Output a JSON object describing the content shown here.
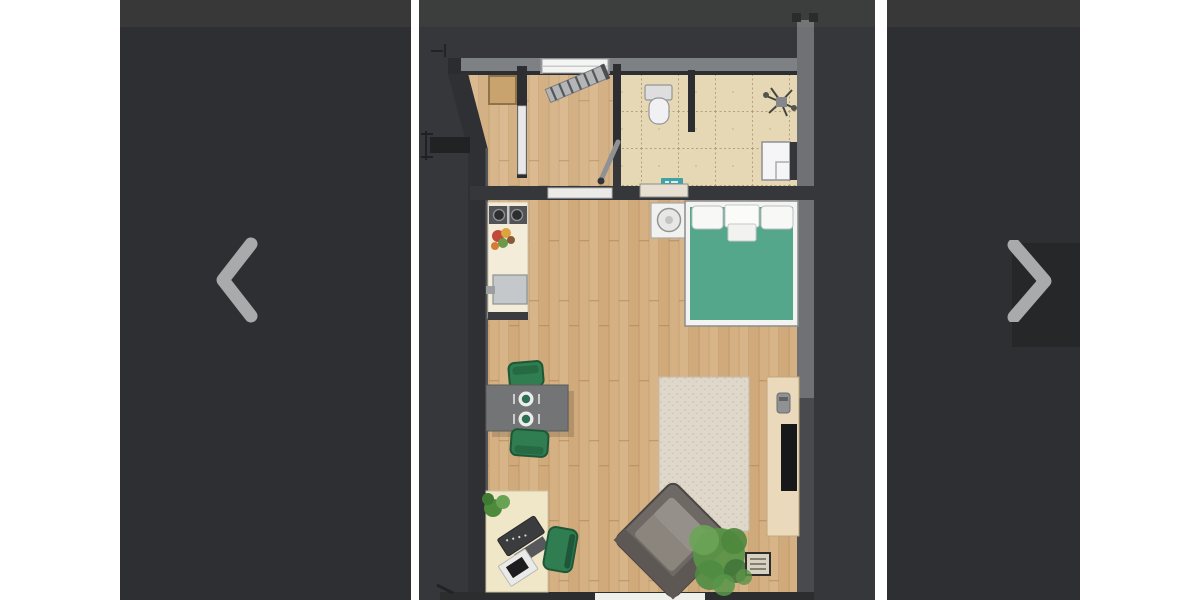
{
  "carousel": {
    "prev_button": {
      "icon": "chevron-left-icon",
      "aria_label": "Previous photo"
    },
    "next_button": {
      "icon": "chevron-right-icon",
      "aria_label": "Next photo"
    },
    "current_slide": {
      "type": "floor-plan-rendering",
      "description": "Top-down 3D rendering of a studio apartment floor plan on a dark background",
      "rooms": [
        "entry hall",
        "bathroom",
        "kitchenette",
        "living and sleeping area"
      ],
      "furniture": [
        "entry wardrobe",
        "loft ladder",
        "toilet",
        "shower cabin",
        "teal bath mat",
        "bathroom plant",
        "kitchen counter with stove and sink",
        "fruit bowl",
        "nightstand with lamp",
        "double bed with green cover and white pillows",
        "gray dining table with two place settings",
        "two green dining chairs",
        "beige area rug",
        "tv sideboard with tv",
        "gray corner sofa",
        "floor plant with slatted side table",
        "desk with work chair",
        "green lounge chair"
      ]
    }
  },
  "palette": {
    "backdrop": "#2d2f32",
    "slide_background": "#35373a",
    "chevron": "#a8aaac",
    "wall_dark": "#2e3034",
    "wall_light": "#7e8184",
    "wood_floor": "#d5b083",
    "tile_floor": "#e6d8b4",
    "bed_cover": "#55a78b",
    "chair_green": "#2f7d51",
    "rug": "#ded7ca",
    "sideboard": "#eadabb",
    "kitchen_counter": "#f3ecd9",
    "bath_mat_teal": "#3fa3a6",
    "sofa": "#6f6965",
    "desk": "#efe7c8",
    "plant_green": "#5a9348"
  }
}
